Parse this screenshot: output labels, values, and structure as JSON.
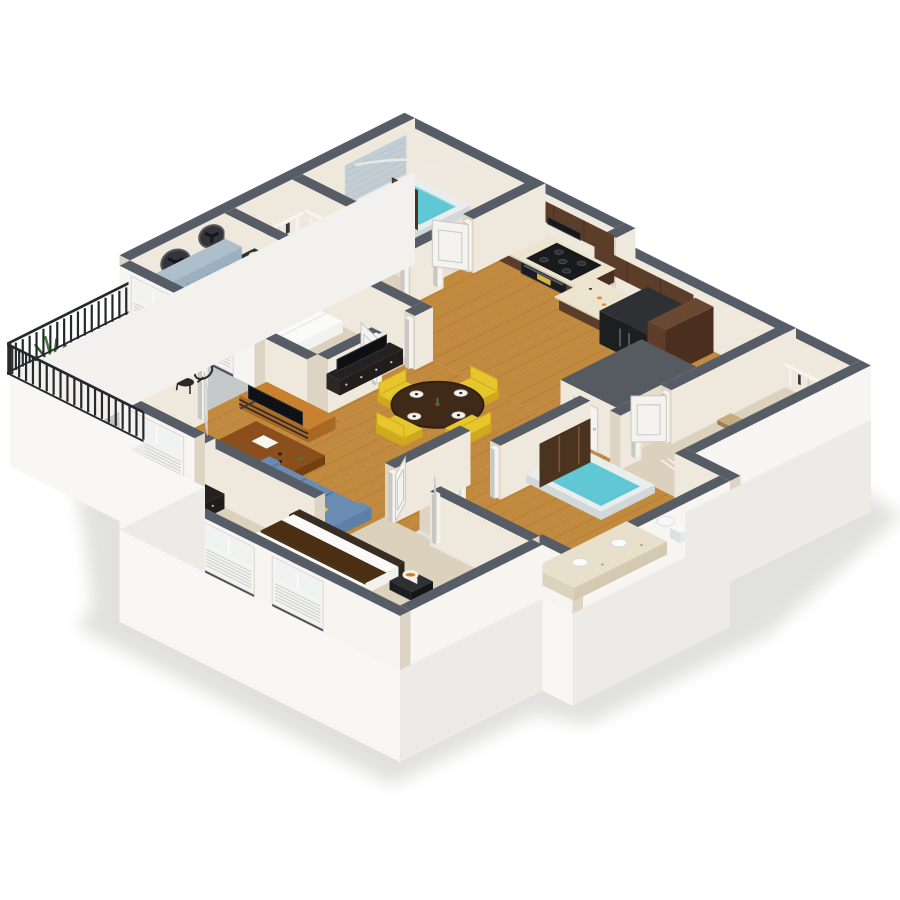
{
  "scene": {
    "label": "3D isometric floor plan render of a two-bedroom, two-bathroom apartment with balcony",
    "background": "#ffffff",
    "palette": {
      "cap": "#575d66",
      "wallIn": "#efe9dd",
      "wallInD": "#e6ddcd",
      "wallEnd": "#ddd4c4",
      "wallOut": "#f6f5f2",
      "slabS": "#f8f7f5",
      "slabE": "#ecebe7",
      "slabW": "#f2f1ee",
      "shadow": "#d8d8d6",
      "wood": "#c18a3e",
      "woodD": "#a87430",
      "woodLine": "#8a5f23",
      "carpet": "#dbd1bc",
      "carpetD": "#cfc3aa",
      "tileBeige": "#e8e1d3",
      "tileLine": "#d6cbb6",
      "concrete": "#c5c8ca",
      "concreteD": "#b2b5b7",
      "rail": "#26282c",
      "water": "#5fc8d4",
      "tubRim": "#e9eded",
      "tubSide": "#d2d8d9",
      "tileWall": "#c3ced4",
      "walnut": "#5c3d2a",
      "walnutD": "#4a2f1f",
      "walnutT": "#6b4832",
      "counter": "#ece4cf",
      "counterD": "#ded5bd",
      "black": "#1d1e20",
      "blackT": "#2e3033",
      "blackS": "#141517",
      "steel": "#9aa2a6",
      "sofa": "#5d80a8",
      "sofaD": "#4d6f96",
      "sofaT": "#6b8cb2",
      "pillowY": "#e6c63e",
      "pillowP": "#efe8d8",
      "hb": "#9db0bf",
      "hbD": "#8598a9",
      "hbT": "#aebecb",
      "bedW": "#fafaf8",
      "bedS": "#e8e8e4",
      "bedE": "#f1f1ee",
      "orange": "#dd5b36",
      "brown": "#6d4a25",
      "chairY": "#e7c52c",
      "chairYD": "#cfa91d",
      "dinT": "#3f2a17",
      "dinTD": "#2f1f10",
      "desk": "#8a4f1d",
      "deskD": "#73400f",
      "tv": "#101114",
      "tvW": "#c8812f",
      "tvWD": "#a96824",
      "frame": "#3a3c40",
      "lampG": "#c8861e",
      "lampW": "#f1efe9",
      "lampLit": "#f3e9c9",
      "green": "#3e7d37",
      "greenD": "#2f6129",
      "pot": "#4a3b2e",
      "curtain": "#4a3420",
      "curtainL": "#7a5a35",
      "door": "#f4f3f0",
      "doorE": "#c9c7c2",
      "glass": "#dfe7e8",
      "wire": "#f5f5f3",
      "boxTop": "#555b61",
      "vanity": "#e9e0cc",
      "sinkW": "#fbfbfa",
      "runner": "#4a2f15",
      "dk2": "#252120",
      "knob": "#b9bdc1",
      "toiletW": "#f6f7f7",
      "toiletS": "#dde0e1",
      "sill": "#494e55",
      "louver": "#cdd2d1",
      "shutterHi": "#eef2f1"
    },
    "rooms": [
      {
        "id": "master-bathroom",
        "name": "Master Bathroom",
        "features": [
          "bathtub-shower",
          "cyan-water",
          "gray-tile-surround",
          "curved-shower-rod",
          "brown-shower-curtain",
          "toilet"
        ]
      },
      {
        "id": "master-closet",
        "name": "Master Walk-in Closet",
        "features": [
          "white-wire-shelving",
          "hanging-clothes",
          "baskets",
          "hamper"
        ]
      },
      {
        "id": "master-bedroom",
        "name": "Master Bedroom",
        "features": [
          "blue-tufted-wingback-headboard",
          "white-duvet-bed",
          "brown-and-orange-accent-pillows",
          "dark-nightstand-with-lamp",
          "two-dark-wall-clocks",
          "media-dresser-with-tv",
          "tan-carpet"
        ]
      },
      {
        "id": "kitchen",
        "name": "Kitchen",
        "features": [
          "l-shaped-dark-walnut-cabinets",
          "black-french-door-refrigerator",
          "black-cooktop-and-oven",
          "built-in-microwave",
          "cream-countertops",
          "breakfast-bar-island-with-sink",
          "two-dark-bar-stools",
          "wood-floor"
        ]
      },
      {
        "id": "dining-area",
        "name": "Dining Area",
        "features": [
          "round-dark-wood-table",
          "four-yellow-chairs",
          "place-settings",
          "wood-floor"
        ]
      },
      {
        "id": "living-room",
        "name": "Living Room",
        "features": [
          "blue-sofa-with-yellow-pillows",
          "wood-and-metal-desk",
          "wood-tv-stand-with-tv",
          "wood-floor"
        ]
      },
      {
        "id": "balcony",
        "name": "Balcony",
        "features": [
          "black-slat-railing",
          "concrete-floor",
          "potted-palm",
          "glass-bistro-table",
          "black-wire-chair",
          "french-door"
        ]
      },
      {
        "id": "hallway",
        "name": "Hallway",
        "features": [
          "wood-floor",
          "white-panel-doors"
        ]
      },
      {
        "id": "utility-closet",
        "name": "Utility Closet",
        "features": [
          "closed-room-gray-roof"
        ]
      },
      {
        "id": "second-closet",
        "name": "Second Walk-in Closet",
        "features": [
          "white-wire-shelving",
          "hanging-clothes",
          "shoe-rack",
          "baskets",
          "hamper",
          "tan-carpet"
        ]
      },
      {
        "id": "second-bathroom",
        "name": "Second Bathroom",
        "features": [
          "bathtub-with-cyan-water",
          "dark-shower-curtain",
          "double-sink-vanity",
          "toilet"
        ]
      },
      {
        "id": "second-bedroom",
        "name": "Second Bedroom",
        "features": [
          "white-bed-with-brown-runner",
          "dark-dresser",
          "gold-drum-lamps",
          "nightstand",
          "tan-carpet",
          "shuttered-windows"
        ]
      }
    ],
    "exterior": {
      "windows": "white-plantation-shutter-windows-on-southwest-walls",
      "walls": "cream-walls-with-dark-gray-top-caps",
      "base": "white-slab-base"
    }
  }
}
